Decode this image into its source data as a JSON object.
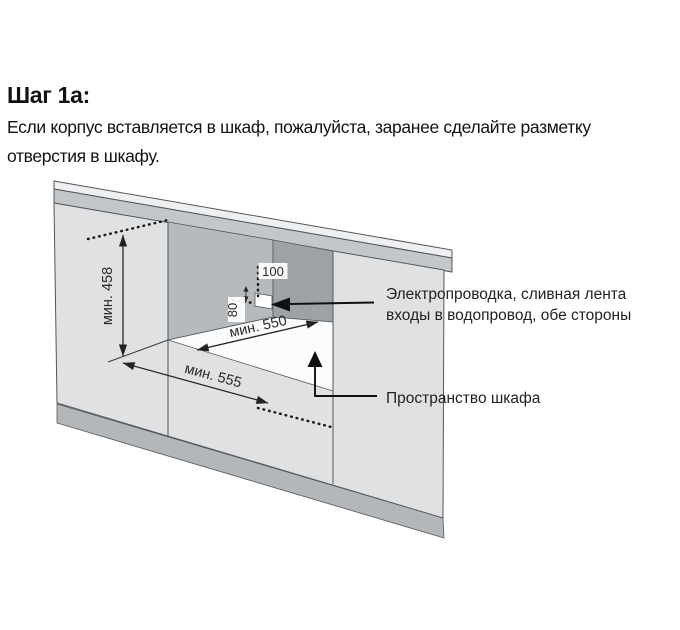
{
  "header": {
    "title": "Шаг 1а:",
    "body_line1": "Если корпус вставляется в шкаф, пожалуйста, заранее сделайте разметку",
    "body_line2": "отверстия в шкафу."
  },
  "diagram": {
    "dimensions": {
      "niche_height": "мин. 458",
      "niche_depth": "мин. 550",
      "niche_width": "мин. 555",
      "hole_top_offset": "100",
      "hole_side_offset": "80"
    },
    "callouts": {
      "utilities_line1": "Электропроводка, сливная лента",
      "utilities_line2": "входы в водопровод, обе стороны",
      "cabinet_space": "Пространство шкафа"
    },
    "colors": {
      "counter_top": "#edeff0",
      "counter_front": "#c4c7ca",
      "cabinet_face": "#dfe1e3",
      "plinth": "#b3b7ba",
      "niche_side_wall": "#b7babd",
      "niche_back_wall": "#9da2a7",
      "niche_floor": "#fbfcfd",
      "hole": "#ffffff",
      "outline": "#54575b",
      "annotation": "#111111"
    }
  }
}
